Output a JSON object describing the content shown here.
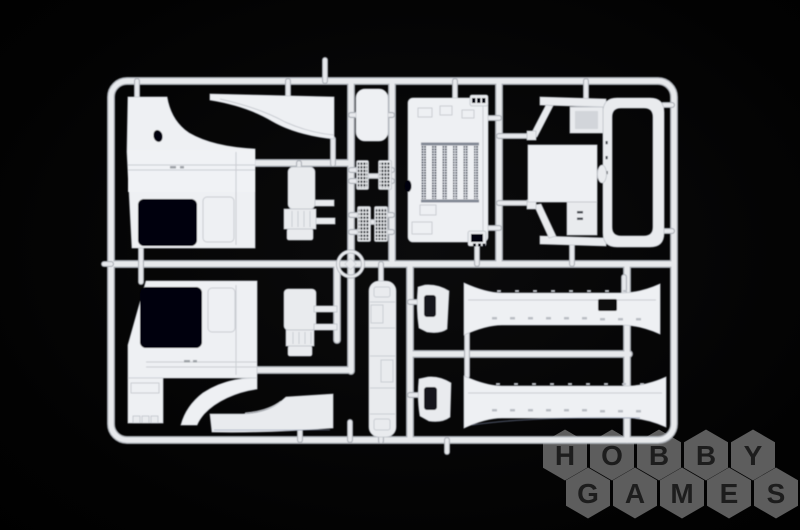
{
  "scene": {
    "subject": "white plastic model-kit sprue with truck cab parts on black background",
    "background_color": "#050505",
    "sprue_color": "#e9ebee",
    "sprue_shadow_color": "#a9adb4"
  },
  "watermark": {
    "line1": "HOBBY",
    "line2": "GAMES",
    "hex_fill": "#5d5d5d",
    "letter_color": "#1d1d1d"
  }
}
